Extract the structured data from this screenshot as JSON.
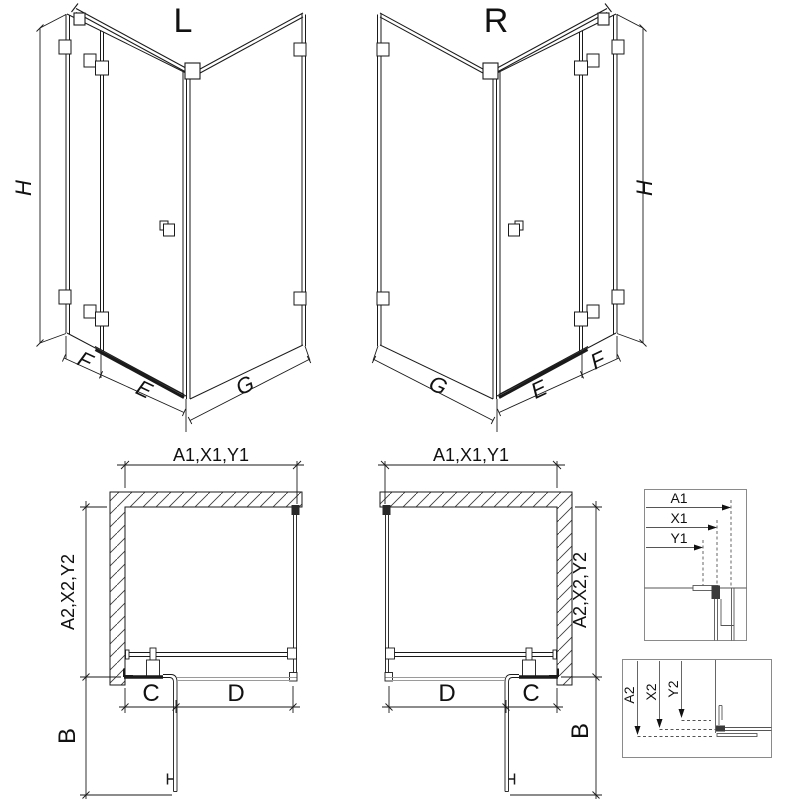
{
  "diagram": {
    "views": {
      "iso_left": {
        "title": "L",
        "height_label": "H",
        "front_labels": [
          "F",
          "E"
        ],
        "side_label": "G"
      },
      "iso_right": {
        "title": "R",
        "height_label": "H",
        "front_labels": [
          "F",
          "E"
        ],
        "side_label": "G"
      },
      "plan_left": {
        "width_label": "A1,X1,Y1",
        "depth_label": "A2,X2,Y2",
        "door_swing_label": "B",
        "fixed_label": "C",
        "door_label": "D"
      },
      "plan_right": {
        "width_label": "A1,X1,Y1",
        "depth_label": "A2,X2,Y2",
        "door_swing_label": "B",
        "fixed_label": "C",
        "door_label": "D"
      },
      "detail_top": {
        "labels": [
          "A1",
          "X1",
          "Y1"
        ]
      },
      "detail_bottom": {
        "labels": [
          "A2",
          "X2",
          "Y2"
        ]
      }
    },
    "colors": {
      "ink": "#1a1a1a",
      "gray": "#9a9a9a",
      "detail_line": "#555555",
      "box_border": "#8a8a8a",
      "hatch": "#3c3c3c",
      "background": "#ffffff"
    }
  }
}
